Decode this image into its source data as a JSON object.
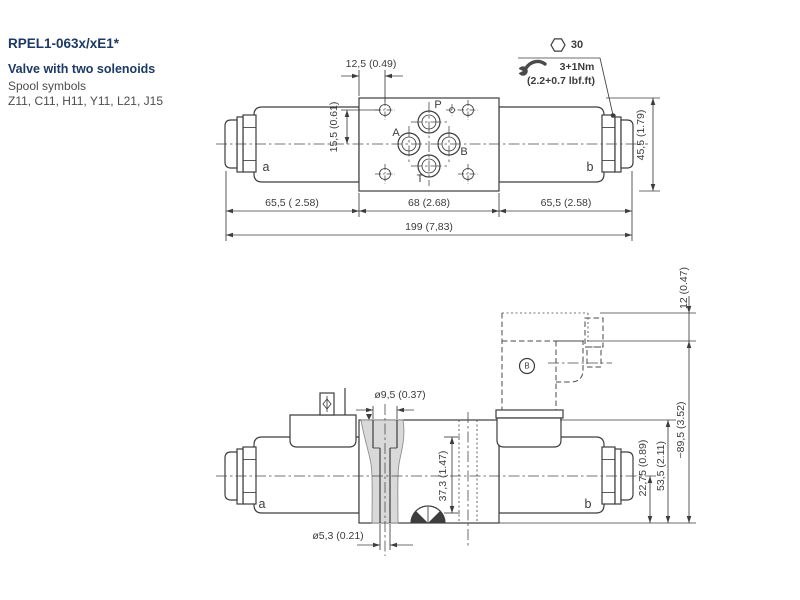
{
  "header": {
    "product_code": "RPEL1-063x/xE1*",
    "subtitle": "Valve with two solenoids",
    "note_line1": "Spool symbols",
    "note_line2": "Z11, C11, H11, Y11, L21, J15"
  },
  "torque_callout": {
    "wrench_size": "30",
    "torque_metric": "3+1Nm",
    "torque_imperial": "(2.2+0.7 lbf.ft)"
  },
  "top_view": {
    "port_labels": {
      "p": "P",
      "a": "A",
      "b": "B",
      "t": "T"
    },
    "solenoid_labels": {
      "left": "a",
      "right": "b"
    },
    "dimensions": {
      "offset_x": "12,5 (0.49)",
      "offset_y": "15,5 (0.61)",
      "body_height": "45,5 (1.79)",
      "segment_left": "65,5 ( 2.58)",
      "segment_center": "68 (2.68)",
      "segment_right": "65,5 (2.58)",
      "total_length": "199 (7,83)"
    }
  },
  "side_view": {
    "solenoid_labels": {
      "left": "a",
      "right": "b"
    },
    "connector_label": "B",
    "dimensions": {
      "hole_top": "ø9,5 (0.37)",
      "hole_bottom": "ø5,3 (0.21)",
      "solenoid_diameter": "37,3 (1.47)",
      "axis_height": "22,75 (0.89)",
      "body_height": "53,5 (2.11)",
      "total_height": "~89,5 (3.52)",
      "connector_top": "12 (0.47)"
    }
  },
  "colors": {
    "heading": "#1c3a63",
    "line": "#3d3d3d",
    "section_fill": "#d9d9d9"
  }
}
